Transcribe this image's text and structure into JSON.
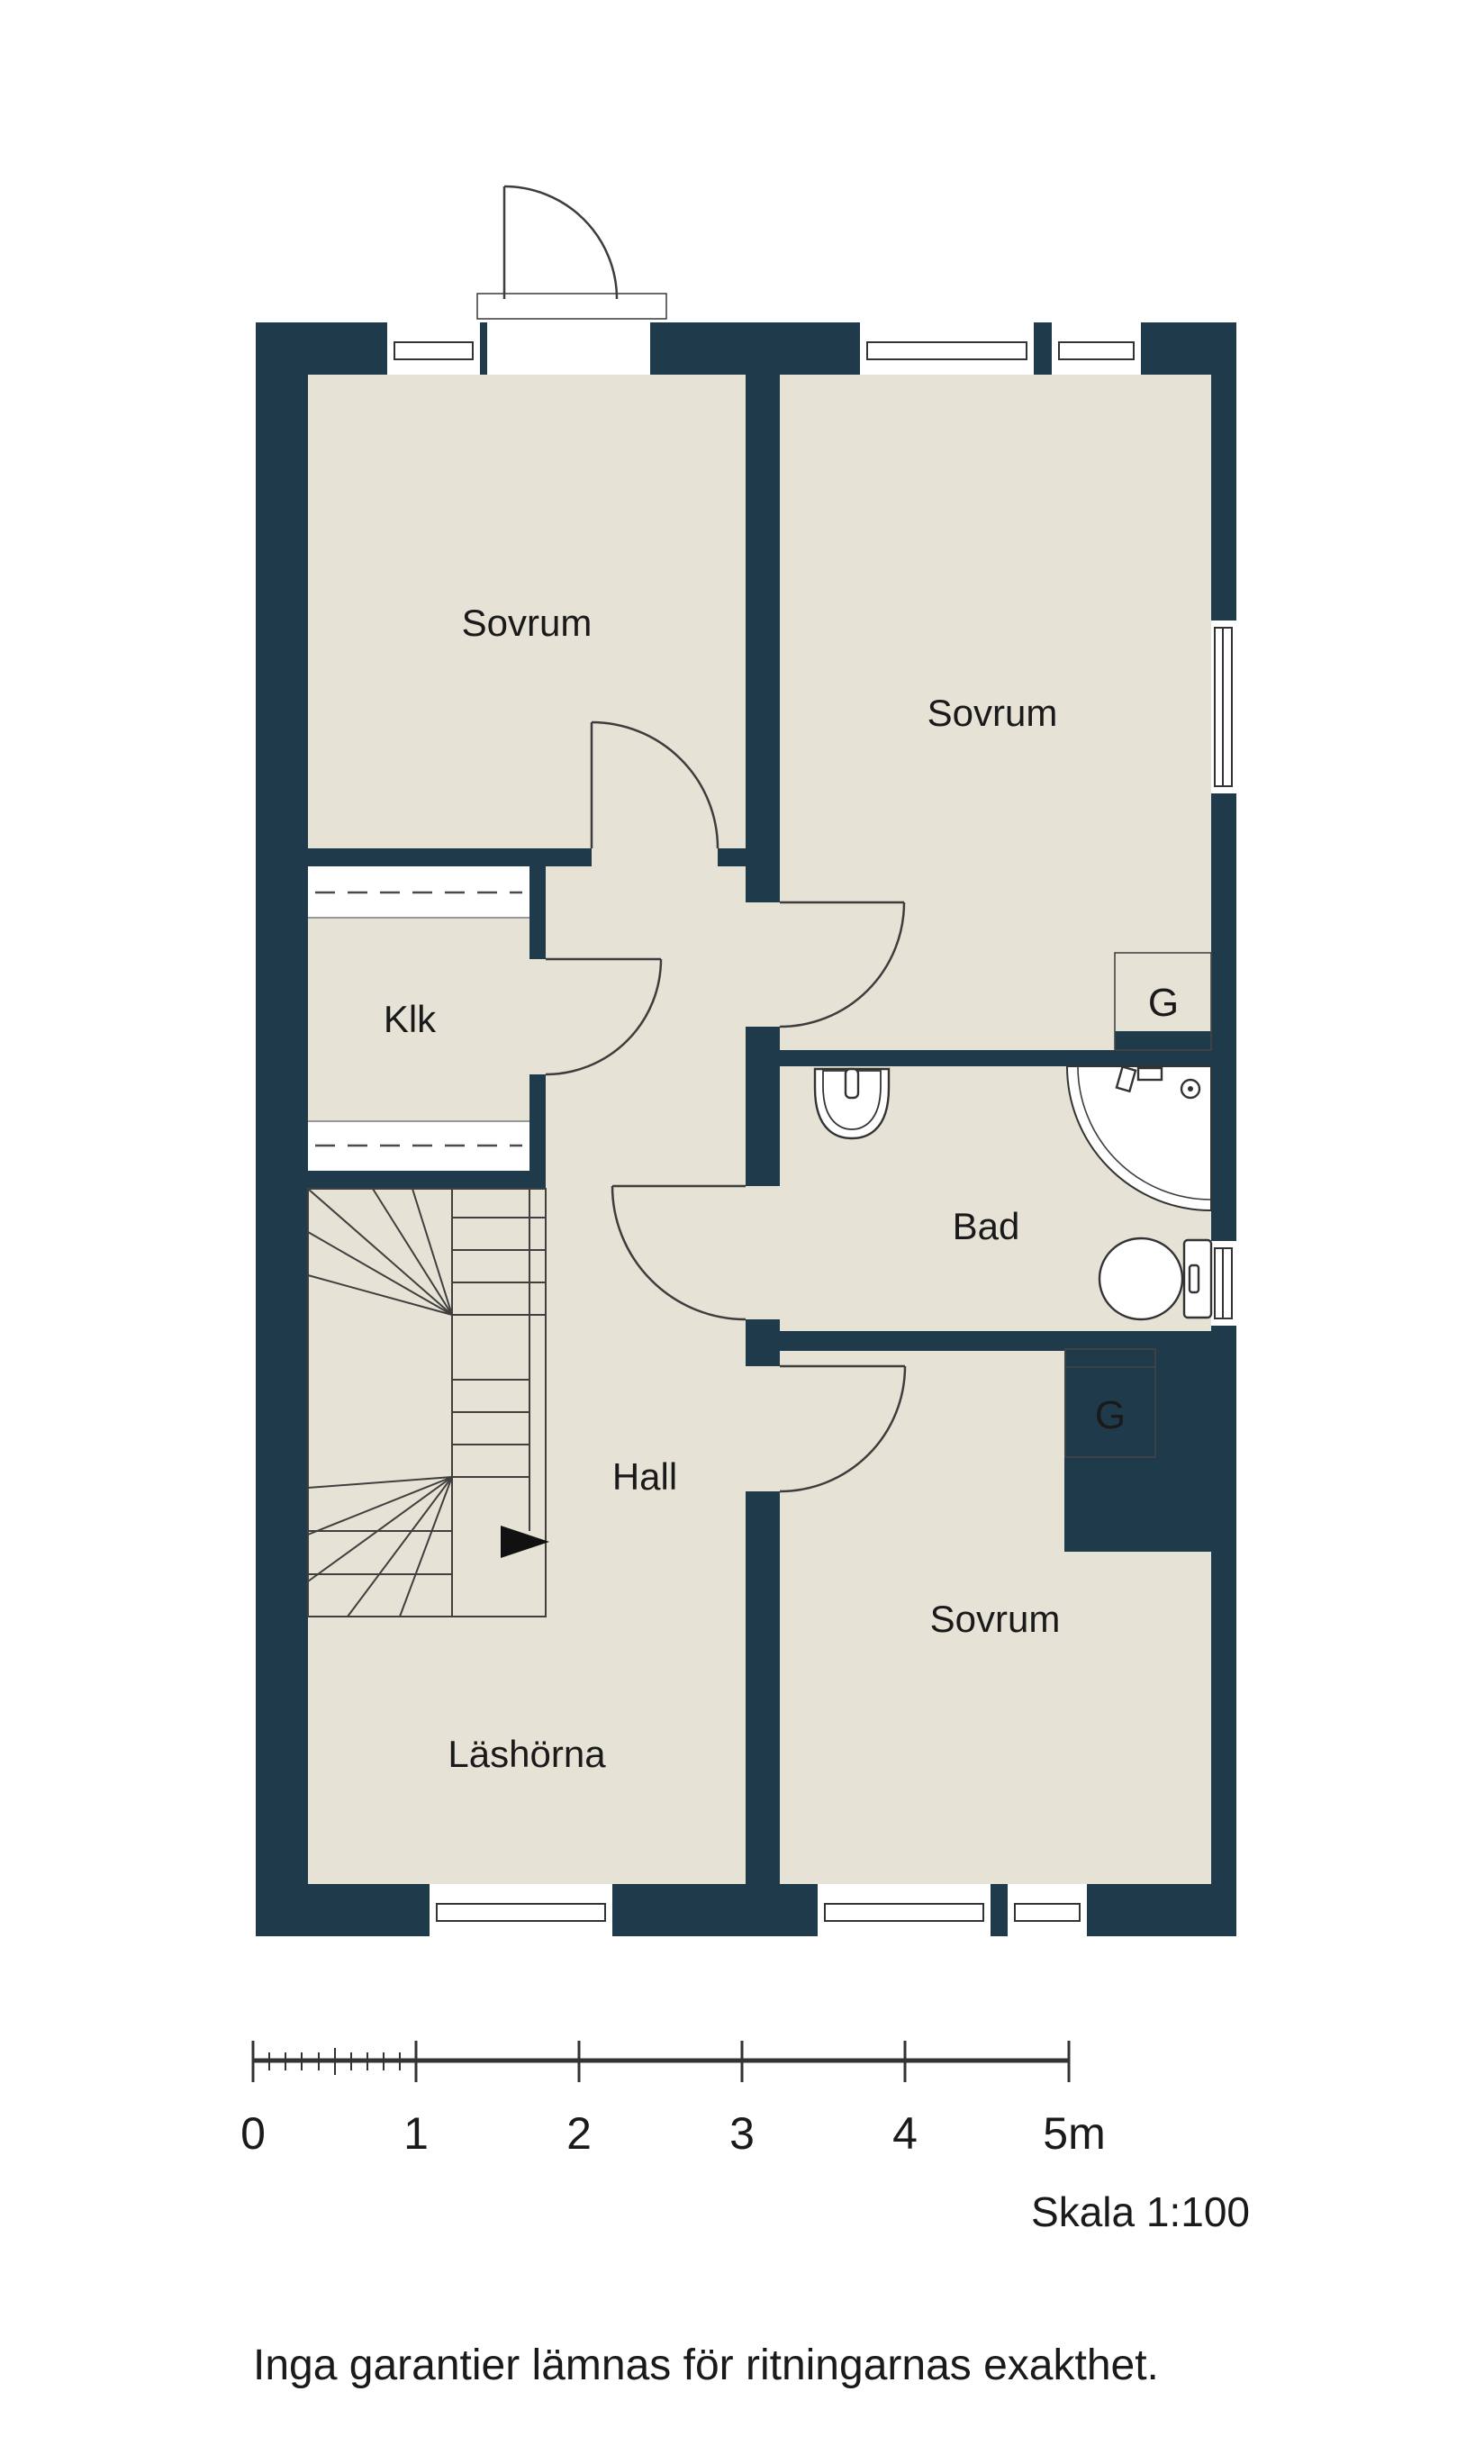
{
  "plan": {
    "colors": {
      "wall": "#1f3a4b",
      "floor": "#e6e2d6",
      "line": "#3d3d3d",
      "text": "#1a1a1a",
      "background": "#ffffff"
    },
    "rooms": {
      "sovrum_top_left": "Sovrum",
      "sovrum_top_right": "Sovrum",
      "klk": "Klk",
      "bad": "Bad",
      "hall": "Hall",
      "lashorna": "Läshörna",
      "sovrum_bottom": "Sovrum"
    },
    "closets": {
      "upper": "G",
      "lower": "G"
    },
    "scale_bar": {
      "tick_labels": [
        "0",
        "1",
        "2",
        "3",
        "4",
        "5m"
      ]
    },
    "scale_note": "Skala 1:100",
    "disclaimer": "Inga garantier lämnas för ritningarnas exakthet."
  }
}
